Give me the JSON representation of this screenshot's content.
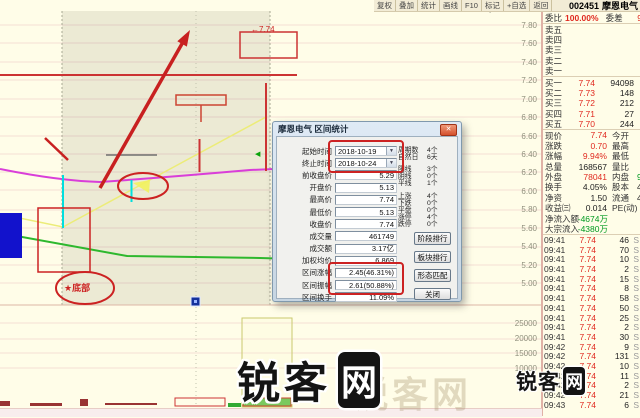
{
  "toolbar": {
    "buttons": [
      "复权",
      "叠加",
      "统计",
      "画线",
      "F10",
      "标记",
      "+自选",
      "返回"
    ],
    "stock_id": "002451",
    "stock_name": "摩恩电气"
  },
  "chart": {
    "price_axis": [
      "7.80",
      "7.60",
      "7.40",
      "7.20",
      "7.00",
      "6.80",
      "6.60",
      "6.40",
      "6.20",
      "6.00",
      "5.80",
      "5.60",
      "5.40",
      "5.20",
      "5.00"
    ],
    "volume_axis": [
      "25000",
      "20000",
      "15000",
      "10000"
    ],
    "annotations": {
      "top_box_label": "←7.74",
      "bottom_circle_label": "★底部",
      "green_marker": "◀",
      "diamond_marker": "◇"
    }
  },
  "dialog": {
    "title": "摩恩电气 区间统计",
    "close_glyph": "✕",
    "fields": [
      {
        "label": "起始时间",
        "value": "2018-10-19",
        "cls": "date"
      },
      {
        "label": "终止时间",
        "value": "2018-10-24",
        "cls": "date"
      },
      {
        "label": "前收盘价",
        "value": "5.29"
      },
      {
        "label": "开盘价",
        "value": "5.13"
      },
      {
        "label": "最高价",
        "value": "7.74"
      },
      {
        "label": "最低价",
        "value": "5.13"
      },
      {
        "label": "收盘价",
        "value": "7.74"
      },
      {
        "label": "成交量",
        "value": "461749"
      },
      {
        "label": "成交额",
        "value": "3.17亿"
      },
      {
        "label": "加权均价",
        "value": "6.869"
      },
      {
        "label": "区间涨幅",
        "value": "2.45(46.31%)"
      },
      {
        "label": "区间振幅",
        "value": "2.61(50.88%)"
      },
      {
        "label": "区间换手",
        "value": "11.09%"
      }
    ],
    "stats": [
      {
        "label": "周期数",
        "value": "4个"
      },
      {
        "label": "自然日",
        "value": "6天"
      },
      {
        "label": "阳线",
        "value": "3个",
        "cls": "gap"
      },
      {
        "label": "阴线",
        "value": "0个"
      },
      {
        "label": "平线",
        "value": "1个"
      },
      {
        "label": "上涨",
        "value": "4个",
        "cls": "gap"
      },
      {
        "label": "下跌",
        "value": "0个"
      },
      {
        "label": "平盘",
        "value": "0个"
      },
      {
        "label": "涨停",
        "value": "4个"
      },
      {
        "label": "跌停",
        "value": "0个"
      }
    ],
    "buttons": [
      "阶段排行",
      "板块排行",
      "形态匹配",
      "关闭"
    ]
  },
  "panel": {
    "weibi_label": "委比",
    "weibi_value": "100.00%",
    "weicha_label": "委差",
    "weicha_value": "9",
    "asks": [
      {
        "label": "卖五"
      },
      {
        "label": "卖四"
      },
      {
        "label": "卖三"
      },
      {
        "label": "卖二"
      },
      {
        "label": "卖一"
      }
    ],
    "bids": [
      {
        "label": "买一",
        "price": "7.74",
        "vol": "94098"
      },
      {
        "label": "买二",
        "price": "7.73",
        "vol": "148"
      },
      {
        "label": "买三",
        "price": "7.72",
        "vol": "212"
      },
      {
        "label": "买四",
        "price": "7.71",
        "vol": "27"
      },
      {
        "label": "买五",
        "price": "7.70",
        "vol": "244"
      }
    ],
    "info": [
      {
        "label": "现价",
        "value": "7.74",
        "cls": "red",
        "label2": "今开",
        "value2": ""
      },
      {
        "label": "涨跌",
        "value": "0.70",
        "cls": "red",
        "label2": "最高",
        "value2": ""
      },
      {
        "label": "涨幅",
        "value": "9.94%",
        "cls": "red",
        "label2": "最低",
        "value2": ""
      },
      {
        "label": "总量",
        "value": "168567",
        "cls": "dark",
        "label2": "量比",
        "value2": ""
      },
      {
        "label": "外盘",
        "value": "78041",
        "cls": "red",
        "label2": "内盘",
        "value2": "9",
        "cls2": "green"
      },
      {
        "label": "换手",
        "value": "4.05%",
        "cls": "dark",
        "label2": "股本",
        "value2": "4",
        "cls2": "dark"
      },
      {
        "label": "净资",
        "value": "1.50",
        "cls": "dark",
        "label2": "流通",
        "value2": "4",
        "cls2": "dark"
      },
      {
        "label": "收益㈢",
        "value": "0.014",
        "cls": "dark",
        "label2": "PE(动)",
        "value2": ""
      },
      {
        "label": "净流入额",
        "value": "-4674万",
        "cls": "green",
        "label2": "",
        "value2": ""
      },
      {
        "label": "大宗流入",
        "value": "-4380万",
        "cls": "green",
        "label2": "",
        "value2": ""
      }
    ],
    "ticks": [
      {
        "time": "09:41",
        "price": "7.74",
        "vol": "46",
        "side": "S"
      },
      {
        "time": "09:41",
        "price": "7.74",
        "vol": "70",
        "side": "S"
      },
      {
        "time": "09:41",
        "price": "7.74",
        "vol": "10",
        "side": "S"
      },
      {
        "time": "09:41",
        "price": "7.74",
        "vol": "2",
        "side": "S"
      },
      {
        "time": "09:41",
        "price": "7.74",
        "vol": "15",
        "side": "S"
      },
      {
        "time": "09:41",
        "price": "7.74",
        "vol": "8",
        "side": "S"
      },
      {
        "time": "09:41",
        "price": "7.74",
        "vol": "58",
        "side": "S"
      },
      {
        "time": "09:41",
        "price": "7.74",
        "vol": "50",
        "side": "S"
      },
      {
        "time": "09:41",
        "price": "7.74",
        "vol": "25",
        "side": "S"
      },
      {
        "time": "09:41",
        "price": "7.74",
        "vol": "2",
        "side": "S"
      },
      {
        "time": "09:41",
        "price": "7.74",
        "vol": "30",
        "side": "S"
      },
      {
        "time": "09:42",
        "price": "7.74",
        "vol": "9",
        "side": "S"
      },
      {
        "time": "09:42",
        "price": "7.74",
        "vol": "131",
        "side": "S"
      },
      {
        "time": "09:42",
        "price": "7.74",
        "vol": "10",
        "side": "S"
      },
      {
        "time": "09:42",
        "price": "7.74",
        "vol": "11",
        "side": "S"
      },
      {
        "time": "09:42",
        "price": "7.74",
        "vol": "2",
        "side": "S"
      },
      {
        "time": "09:42",
        "price": "7.74",
        "vol": "21",
        "side": "S"
      },
      {
        "time": "09:43",
        "price": "7.74",
        "vol": "6",
        "side": "S"
      }
    ]
  },
  "icons": {
    "dropdown": "▼"
  },
  "watermark": {
    "text_prefix": "锐客",
    "text_boxed": "网",
    "small_text_prefix": "锐客",
    "small_text_boxed": "网",
    "faint_text": "锐客网"
  },
  "colors": {
    "background": "#fffde8",
    "up_red": "#e02a20",
    "down_green": "#009a20",
    "annotation_red": "#cc2222",
    "magenta_line": "#d93ed9",
    "yellow_line": "#ecec78",
    "green_line": "#2eb82e",
    "cyan_line": "#00dede",
    "blue_block": "#1212cc"
  }
}
